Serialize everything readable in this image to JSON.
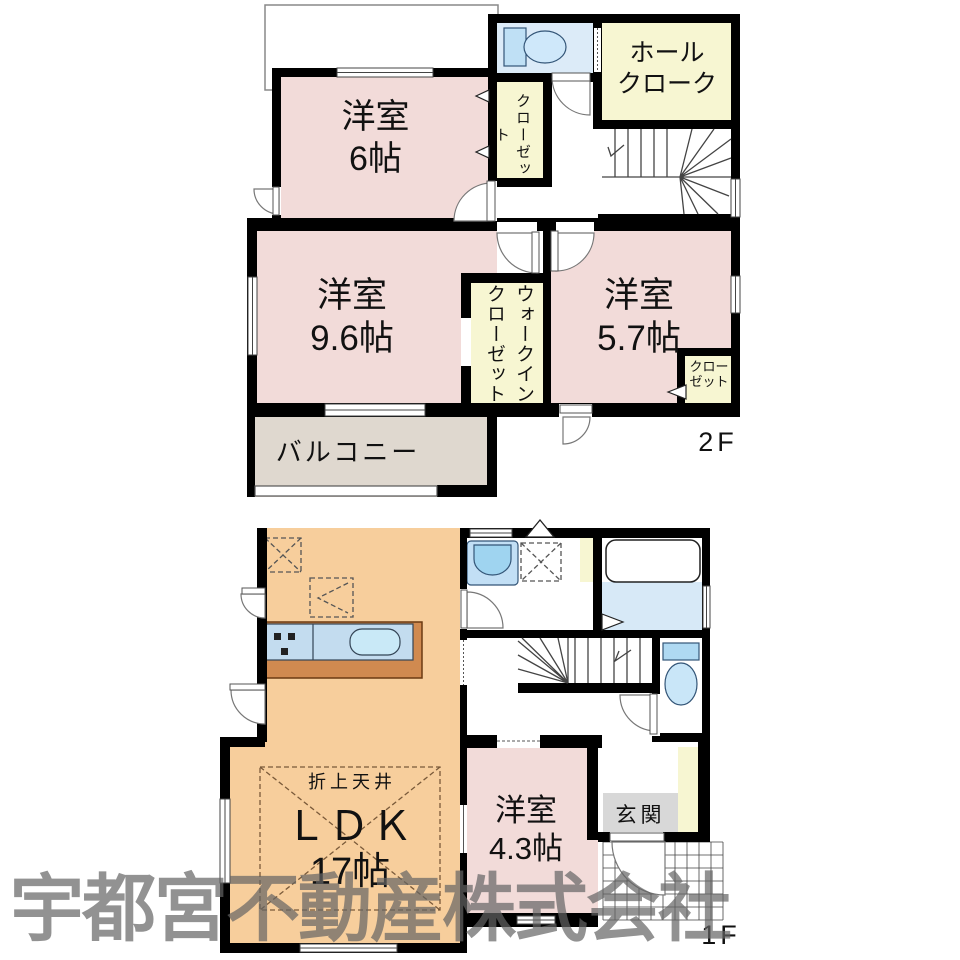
{
  "f2": {
    "label": "2F",
    "west6_name": "洋室",
    "west6_size": "6帖",
    "west96_name": "洋室",
    "west96_size": "9.6帖",
    "west57_name": "洋室",
    "west57_size": "5.7帖",
    "hall_cloak": "ホール\nクローク",
    "closet": "クローゼット",
    "wic": "ウォークイン\nクローゼット",
    "closet_small": "クロー\nゼット",
    "balcony": "バルコニー"
  },
  "f1": {
    "label": "1F",
    "ldk_name": "ＬＤＫ",
    "ldk_size": "17帖",
    "ceiling_note": "折上天井",
    "west43_name": "洋室",
    "west43_size": "4.3帖",
    "entrance": "玄関"
  },
  "watermark": "宇都宮不動産株式会社",
  "colors": {
    "room_pink": "#F2DBD9",
    "room_orange": "#F7CE9C",
    "room_yellow": "#F7F6D2",
    "balcony_beige": "#DFD8CF",
    "water_blue": "#DCEBF8",
    "bath_floor_blue": "#D7E9F7",
    "fixture_blue": "#AFD9F2",
    "fixture_blue_light": "#C9E6F8",
    "counter_top_blue": "#C3DCEF",
    "counter_brown": "#D08A50",
    "entrance_gray": "#D8D8D8",
    "wall_black": "#000000",
    "watermark_gray": "#646464"
  },
  "icons": [
    "toilet-icon",
    "bathtub-icon",
    "washbasin-icon",
    "kitchen-sink-icon",
    "stove-icon",
    "washer-space-icon",
    "fridge-space-icon",
    "pantry-space-icon",
    "stairs-icon",
    "door-arc-icon",
    "sliding-door-icon",
    "window-icon",
    "porch-tile-icon",
    "roof-vent-icon",
    "folding-door-icon",
    "closet-arrow-icon"
  ]
}
